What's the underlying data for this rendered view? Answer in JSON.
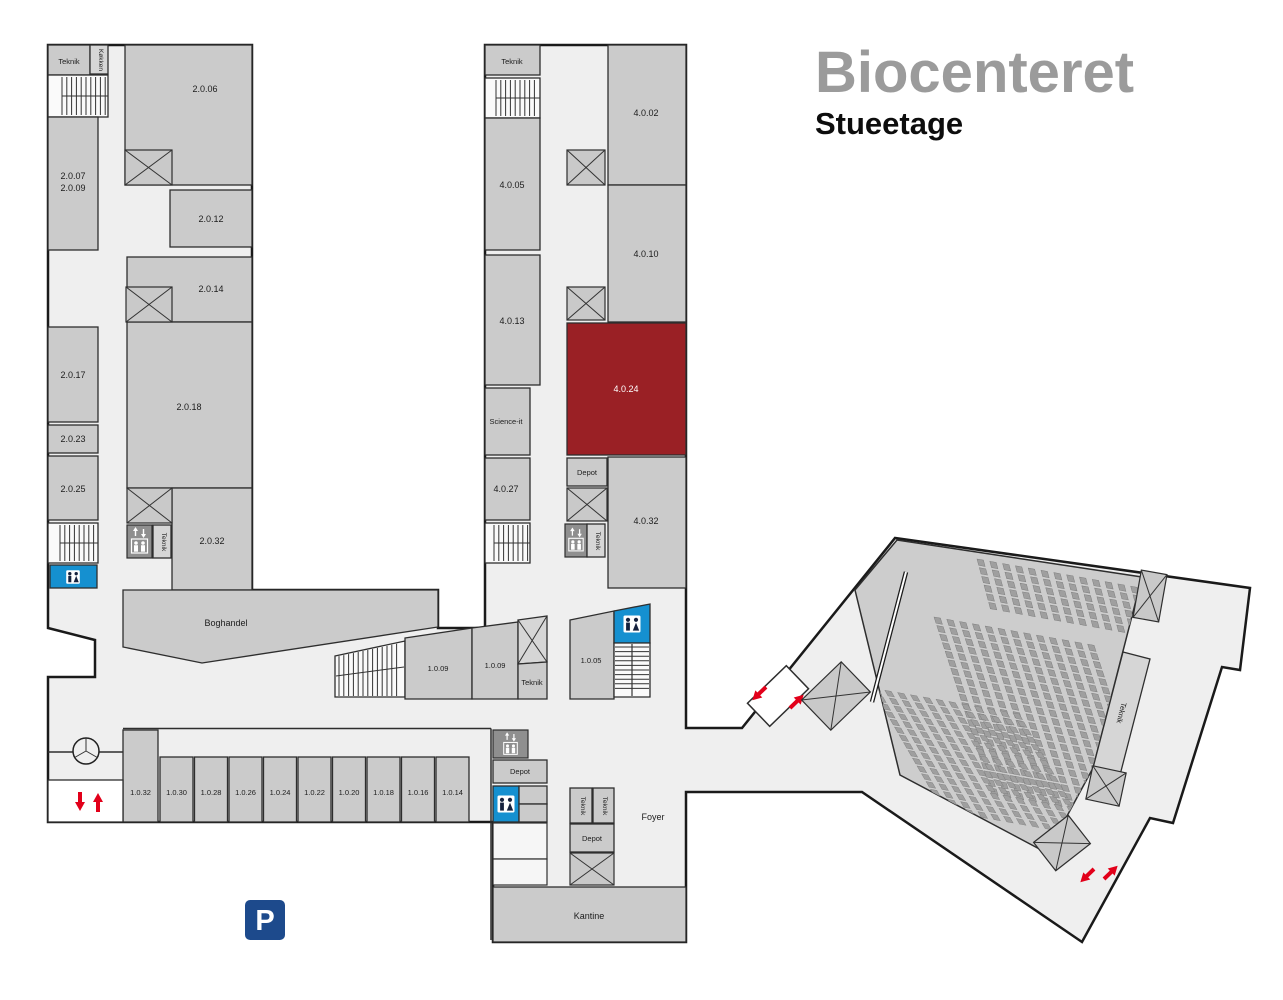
{
  "header": {
    "title": "Biocenteret",
    "subtitle": "Stueetage"
  },
  "west_wing": {
    "teknik_top": "Teknik",
    "kokken": "Køkken",
    "teknik_vert": "Teknik",
    "r2006": "2.0.06",
    "r2007": "2.0.07",
    "r2009": "2.0.09",
    "r2012": "2.0.12",
    "r2014": "2.0.14",
    "r2017": "2.0.17",
    "r2018": "2.0.18",
    "r2023": "2.0.23",
    "r2025": "2.0.25",
    "r2032": "2.0.32"
  },
  "center_wing": {
    "teknik_top": "Teknik",
    "teknik_vert": "Teknik",
    "science_it": "Science-it",
    "depot": "Depot",
    "r4002": "4.0.02",
    "r4005": "4.0.05",
    "r4010": "4.0.10",
    "r4013": "4.0.13",
    "r4024": "4.0.24",
    "r4027": "4.0.27",
    "r4032": "4.0.32",
    "highlighted_room": "4.0.24"
  },
  "retail": {
    "boghandel": "Boghandel"
  },
  "mid_band": {
    "r1009a": "1.0.09",
    "r1009b": "1.0.09",
    "teknik": "Teknik",
    "r1005": "1.0.05"
  },
  "south_block": {
    "rooms_row": [
      "1.0.32",
      "1.0.30",
      "1.0.28",
      "1.0.26",
      "1.0.24",
      "1.0.22",
      "1.0.20",
      "1.0.18",
      "1.0.16",
      "1.0.14"
    ],
    "depot_upper": "Depot",
    "teknik_1": "Teknik",
    "teknik_2": "Teknik",
    "depot_lower": "Depot",
    "foyer": "Foyer",
    "kantine": "Kantine"
  },
  "auditorium": {
    "teknik": "Teknik",
    "seat_banks": [
      {
        "origin": [
          977,
          559
        ],
        "row_dir": [
          0.985,
          0.174
        ],
        "col_dir": [
          0.26,
          0.966
        ],
        "cols": 13,
        "rows": 6,
        "col_gap": 13,
        "row_gap": 9,
        "seat": [
          6.5,
          6.5
        ]
      },
      {
        "origin": [
          934,
          617
        ],
        "row_dir": [
          0.985,
          0.174
        ],
        "col_dir": [
          0.31,
          0.95
        ],
        "cols": 13,
        "rows": 21,
        "col_gap": 13,
        "row_gap": 9,
        "seat": [
          6.5,
          6.5
        ]
      },
      {
        "origin": [
          872,
          688
        ],
        "row_dir": [
          0.985,
          0.174
        ],
        "col_dir": [
          0.5,
          0.866
        ],
        "cols": 12,
        "rows": 16,
        "col_gap": 13,
        "row_gap": 9,
        "seat": [
          6.5,
          6.5
        ]
      }
    ]
  },
  "parking_label": "P",
  "colors": {
    "highlight_room": "#9A2025",
    "wc_blue": "#1590D0",
    "parking_blue": "#1D4A8C",
    "arrow_red": "#E2001A",
    "room_fill": "#CBCBCB",
    "floor_fill": "#EFEFEF",
    "hall_fill": "#CDCDCD",
    "outline": "#1A1A1A"
  }
}
